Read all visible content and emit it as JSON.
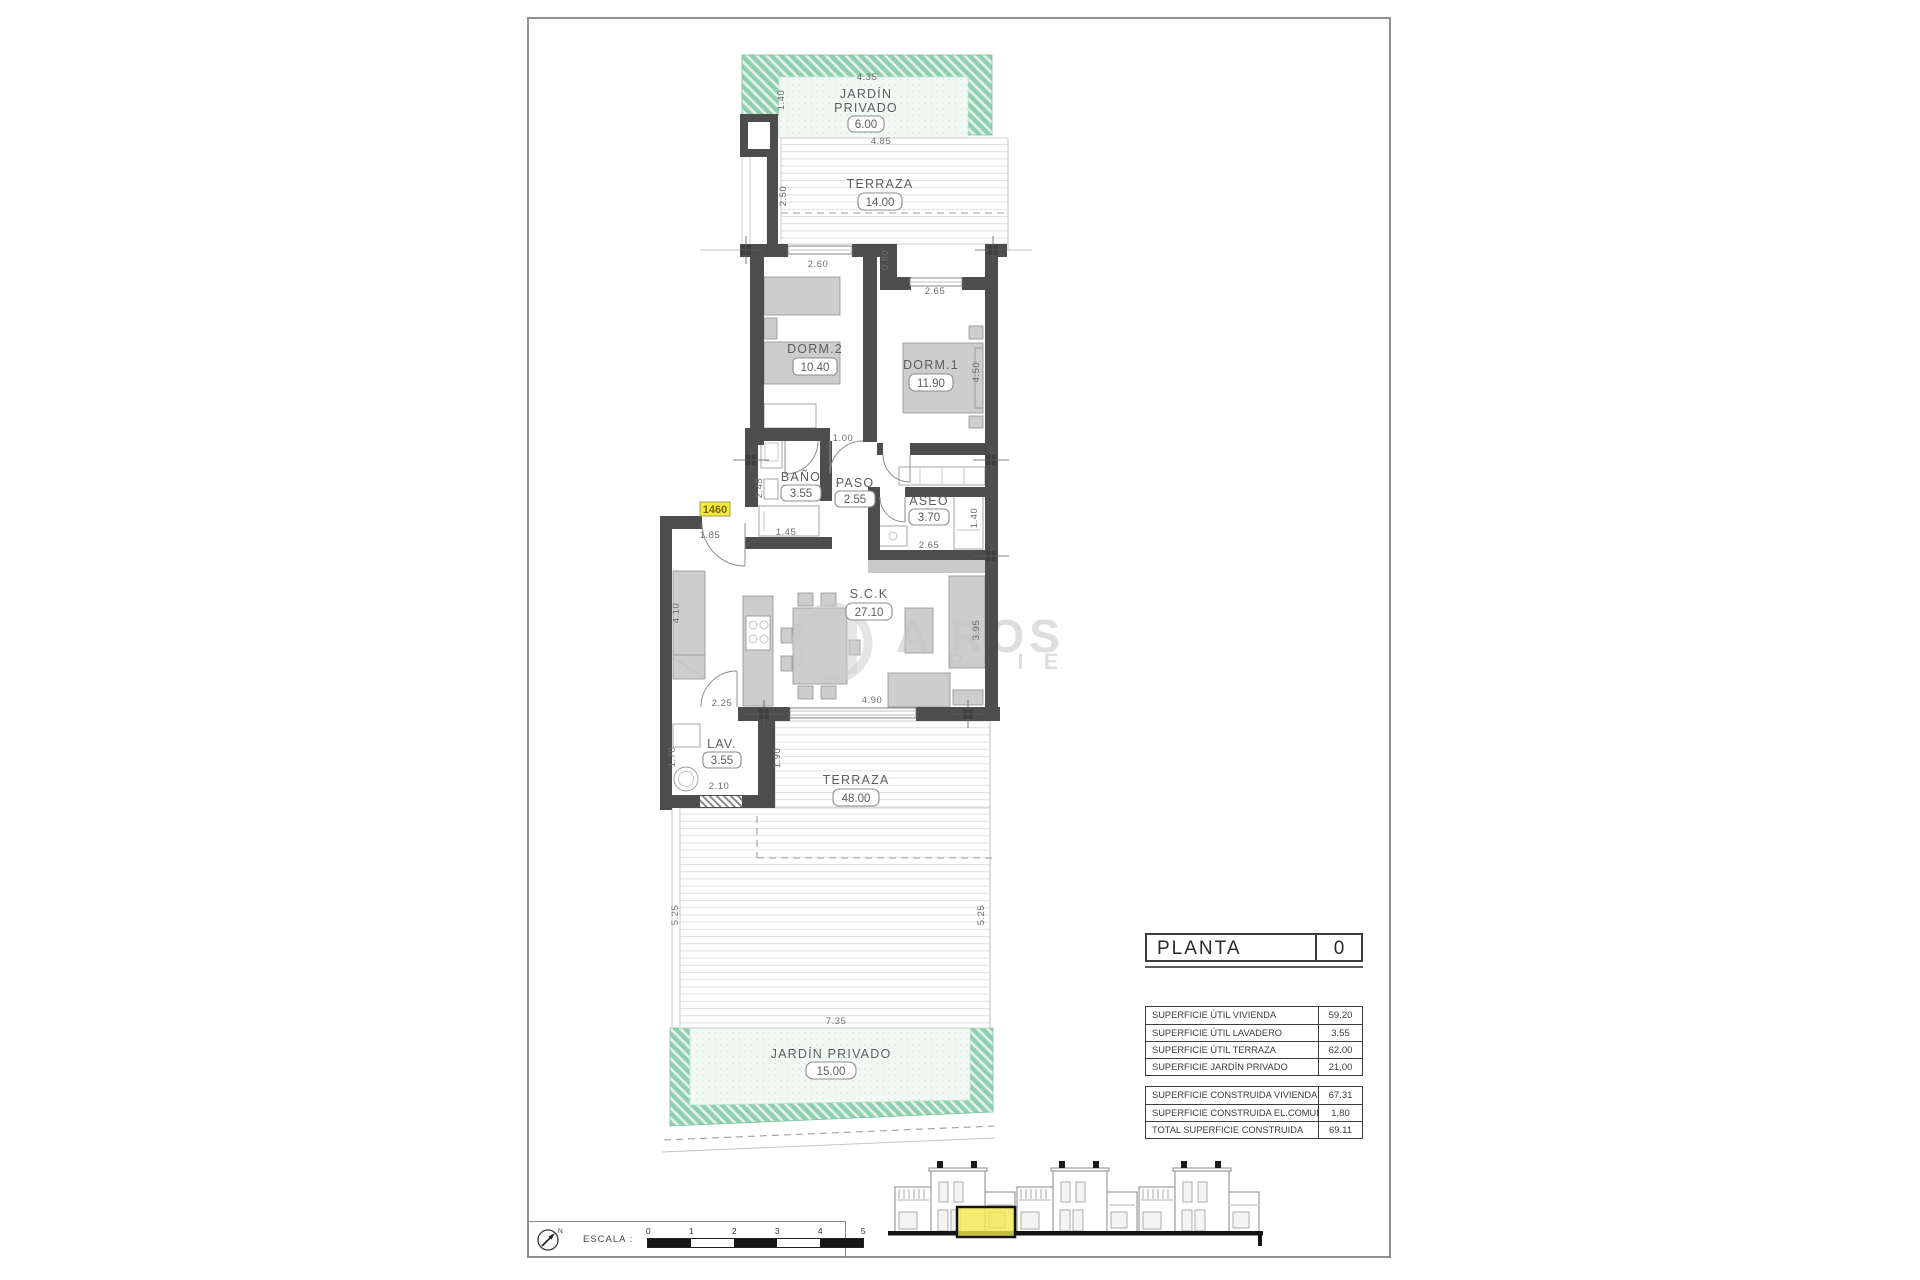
{
  "sheet": {
    "unit_number": "1460",
    "watermark": {
      "line1": "A ROS",
      "line2": "R T I E"
    }
  },
  "rooms": [
    {
      "name": "JARDÍN",
      "name2": "PRIVADO",
      "area": "6.00"
    },
    {
      "name": "TERRAZA",
      "area": "14.00"
    },
    {
      "name": "DORM.2",
      "area": "10.40"
    },
    {
      "name": "DORM.1",
      "area": "11.90"
    },
    {
      "name": "BAÑO",
      "area": "3.55"
    },
    {
      "name": "PASO",
      "area": "2.55"
    },
    {
      "name": "ASEO",
      "area": "3.70"
    },
    {
      "name": "S.C.K",
      "area": "27.10"
    },
    {
      "name": "LAV.",
      "area": "3.55"
    },
    {
      "name": "TERRAZA",
      "area": "48.00"
    },
    {
      "name": "JARDÍN PRIVADO",
      "area": "15.00"
    }
  ],
  "dims": [
    "4.35",
    "1.40",
    "4.85",
    "2.50",
    "2.60",
    "0.80",
    "2.65",
    "4.50",
    "1.00",
    "2.45",
    "1.45",
    "1.85",
    "2.65",
    "1.40",
    "4.10",
    "2.25",
    "4.90",
    "3.95",
    "1.70",
    "2.10",
    "1.90",
    "5.25",
    "5.25",
    "7.35"
  ],
  "planta": {
    "label": "PLANTA",
    "value": "0"
  },
  "surface_table": {
    "rows": [
      {
        "label": "SUPERFICIE ÚTIL VIVIENDA",
        "value": "59.20"
      },
      {
        "label": "SUPERFICIE ÚTIL LAVADERO",
        "value": "3.55"
      },
      {
        "label": "SUPERFICIE ÚTIL TERRAZA",
        "value": "62.00"
      },
      {
        "label": "SUPERFICIE JARDÍN PRIVADO",
        "value": "21,00"
      }
    ]
  },
  "construida_table": {
    "rows": [
      {
        "label": "SUPERFICIE CONSTRUIDA VIVIENDA",
        "value": "67.31"
      },
      {
        "label": "SUPERFICIE CONSTRUIDA EL.COMUNES",
        "value": "1,80"
      },
      {
        "label": "TOTAL SUPERFICIE CONSTRUIDA",
        "value": "69.11"
      }
    ]
  },
  "scale": {
    "label": "ESCALA :",
    "north": "N",
    "ticks": [
      "0",
      "1",
      "2",
      "3",
      "4",
      "5"
    ]
  }
}
